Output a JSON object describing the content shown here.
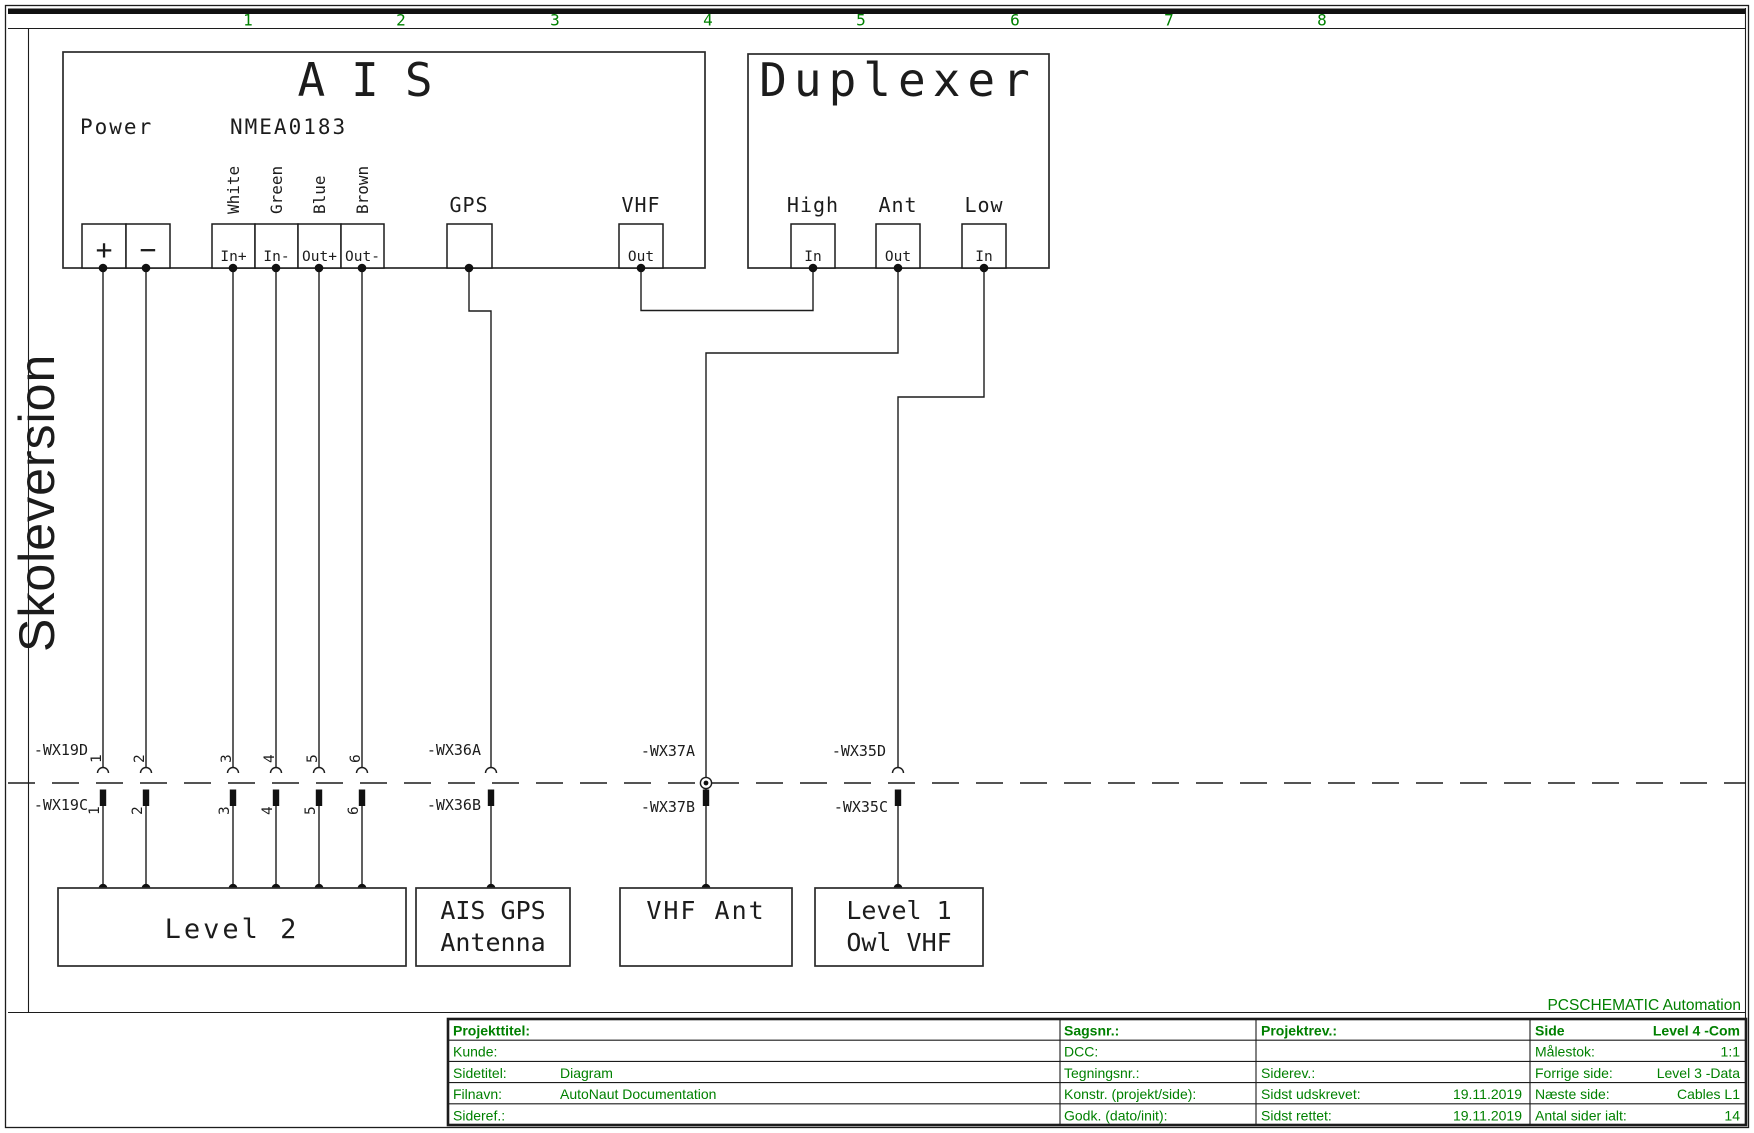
{
  "page": {
    "ruler": [
      "1",
      "2",
      "3",
      "4",
      "5",
      "6",
      "7",
      "8"
    ],
    "watermark": "Skoleversion",
    "brand": "PCSCHEMATIC Automation"
  },
  "ais": {
    "title": "AIS",
    "power": "Power",
    "nmea": "NMEA0183",
    "wire_colors": [
      "White",
      "Green",
      "Blue",
      "Brown"
    ],
    "t_plus": "+",
    "t_minus": "−",
    "t_in_plus": "In+",
    "t_in_minus": "In-",
    "t_out_plus": "Out+",
    "t_out_minus": "Out-",
    "gps": "GPS",
    "vhf": "VHF",
    "vhf_out": "Out"
  },
  "duplexer": {
    "title": "Duplexer",
    "high": "High",
    "ant": "Ant",
    "low": "Low",
    "high_in": "In",
    "ant_out": "Out",
    "low_in": "In"
  },
  "cables": {
    "numbers": [
      "1",
      "2",
      "3",
      "4",
      "5",
      "6"
    ],
    "wx19d": "-WX19D",
    "wx19c": "-WX19C",
    "wx36a": "-WX36A",
    "wx36b": "-WX36B",
    "wx37a": "-WX37A",
    "wx37b": "-WX37B",
    "wx35d": "-WX35D",
    "wx35c": "-WX35C"
  },
  "boxes": {
    "level2": "Level 2",
    "ais_gps_line1": "AIS GPS",
    "ais_gps_line2": "Antenna",
    "vhf_ant": "VHF Ant",
    "level1_line1": "Level 1",
    "level1_line2": "Owl VHF"
  },
  "titleblock": {
    "projekttitel": "Projekttitel:",
    "kunde": "Kunde:",
    "sidetitel": "Sidetitel:",
    "sidetitel_value": "Diagram",
    "filnavn": "Filnavn:",
    "filnavn_value": "AutoNaut Documentation",
    "sideref": "Sideref.:",
    "sagsnr": "Sagsnr.:",
    "dcc": "DCC:",
    "tegningsnr": "Tegningsnr.:",
    "konstr": "Konstr. (projekt/side):",
    "godk": "Godk. (dato/init):",
    "projektrev": "Projektrev.:",
    "siderev": "Siderev.:",
    "sidst_udskrevet": "Sidst udskrevet:",
    "sidst_udskrevet_value": "19.11.2019",
    "sidst_rettet": "Sidst rettet:",
    "sidst_rettet_value": "19.11.2019",
    "side": "Side",
    "side_value": "Level 4 -Com",
    "malestok": "Målestok:",
    "malestok_value": "1:1",
    "forrige": "Forrige side:",
    "forrige_value": "Level 3 -Data",
    "naeste": "Næste side:",
    "naeste_value": "Cables L1",
    "antal": "Antal sider ialt:",
    "antal_value": "14"
  },
  "colors": {
    "green": "#008000",
    "line": "#1c1c1c",
    "watermark": "#a9a9a9"
  }
}
